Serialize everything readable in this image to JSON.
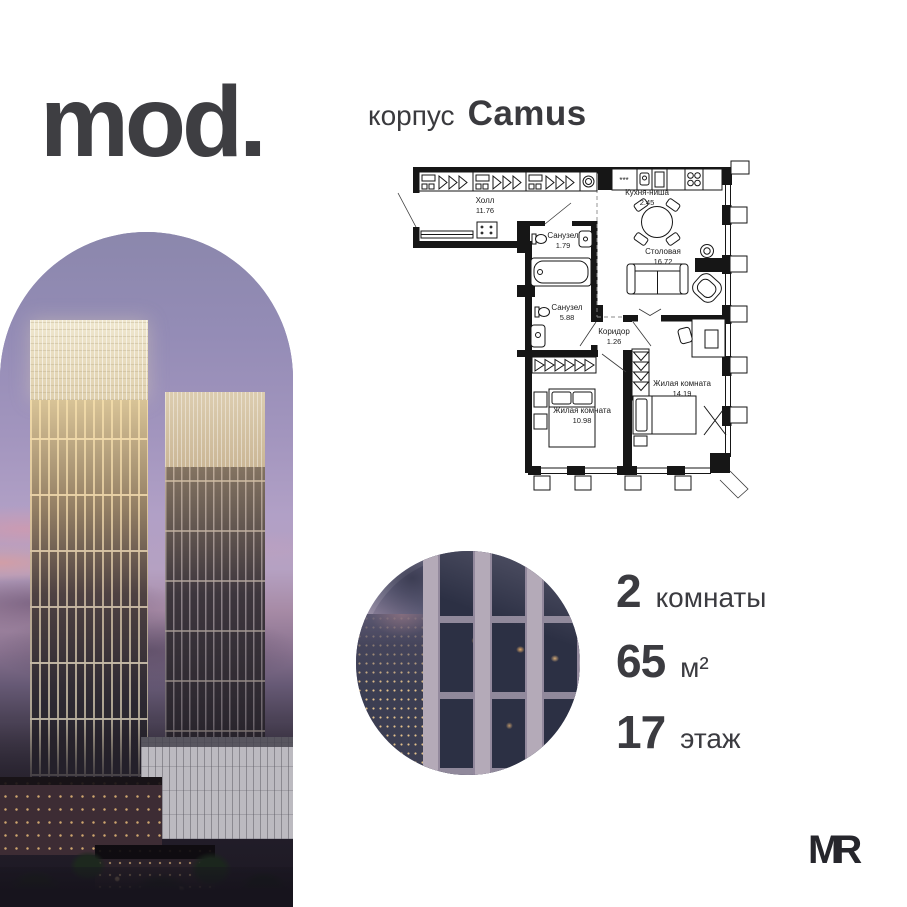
{
  "brand": {
    "logo": "mod.",
    "developer_logo": "MR"
  },
  "header": {
    "prefix": "корпус",
    "name": "Camus"
  },
  "plan": {
    "rooms": [
      {
        "name": "Холл",
        "area": "11.76"
      },
      {
        "name": "Санузел",
        "area": "1.79"
      },
      {
        "name": "Кухня-ниша",
        "area": "2.45"
      },
      {
        "name": "Столовая",
        "area": "16.72"
      },
      {
        "name": "Санузел",
        "area": "5.88"
      },
      {
        "name": "Коридор",
        "area": "1.26"
      },
      {
        "name": "Жилая комната",
        "area": "14.19"
      },
      {
        "name": "Жилая комната",
        "area": "10.98"
      }
    ],
    "kitchen_symbol": "***"
  },
  "stats": [
    {
      "value": "2",
      "label": "комнаты"
    },
    {
      "value": "65",
      "label": "м²"
    },
    {
      "value": "17",
      "label": "этаж"
    }
  ],
  "colors": {
    "text": "#3b3b40",
    "plan_line": "#161616",
    "sky_top": "#8b87ac",
    "sky_pink": "#d2919f",
    "crown_light": "#efe7cf"
  }
}
